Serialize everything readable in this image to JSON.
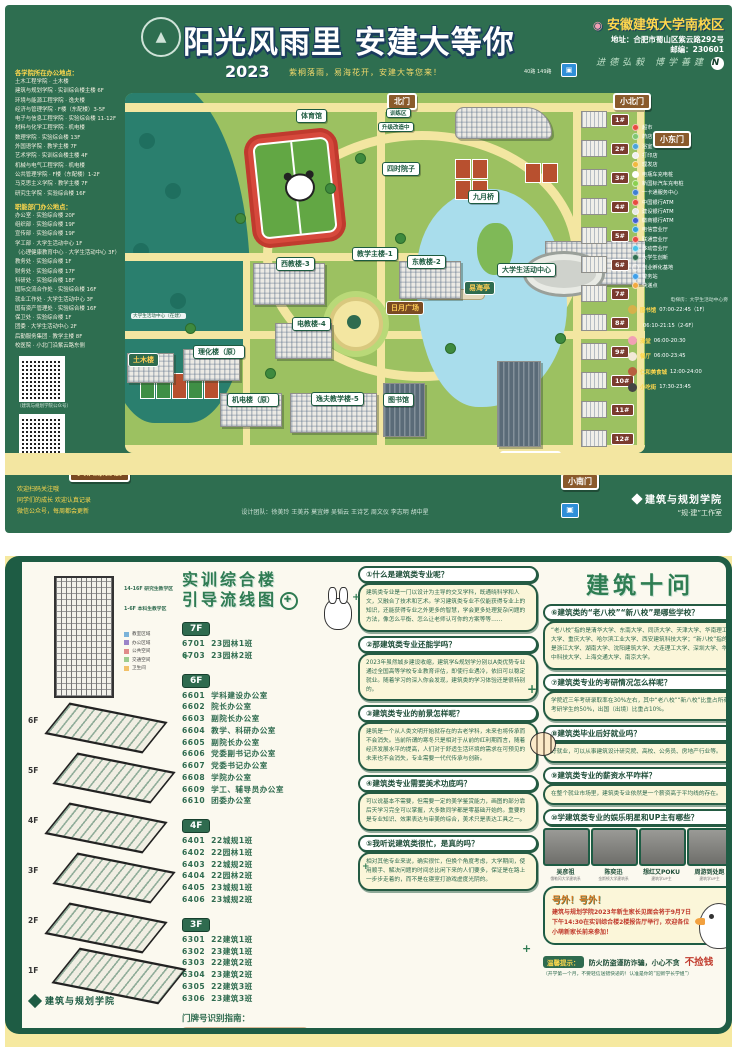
{
  "top_poster": {
    "title": "阳光风雨里 安建大等你",
    "year": "2023",
    "subtitle": "紫桐落雨，易海花开，安建大等您来！",
    "bus_note": "40路 149路",
    "campus": {
      "pin_icon": "📍",
      "name": "安徽建筑大学南校区",
      "address": "地址：合肥市蜀山区紫云路292号",
      "zip": "邮编：230601",
      "motto": "进德弘毅 博学善建",
      "compass": "N"
    },
    "sidebar": {
      "colleges_header": "各学院所在办公地点：",
      "colleges": [
        "土木工程学院 · 土木楼",
        "建筑与规划学院 · 实训综合楼主楼 6F",
        "环境与能源工程学院 · 逸夫楼",
        "经济与管理学院 · F楼（东配楼）3-5F",
        "电子与信息工程学院 · 实验综合楼 11-12F",
        "材料与化学工程学院 · 机电楼",
        "数理学院 · 实验综合楼 13F",
        "外国语学院 · 教学主楼 7F",
        "艺术学院 · 实训综合楼主楼 4F",
        "机械与电气工程学院 · 机电楼",
        "公共管理学院 · F楼（东配楼）1-2F",
        "马克思主义学院 · 教学主楼 7F",
        "研究生学院 · 实验综合楼 16F"
      ],
      "departments_header": "职能部门办公地点：",
      "departments": [
        "办公室 · 实验综合楼 20F",
        "组织部 · 实验综合楼 19F",
        "宣传部 · 实验综合楼 19F",
        "学工部 · 大学生活动中心 1F",
        "（心理健康教育中心 · 大学生活动中心 3F）",
        "教务处 · 实验综合楼 1F",
        "财务处 · 实验综合楼 17F",
        "科研处 · 实验综合楼 18F",
        "国际交流合作处 · 实验综合楼 16F",
        "就业工作处 · 大学生活动中心 3F",
        "国有资产管理处 · 实验综合楼 16F",
        "保卫处 · 实验综合楼 1F",
        "团委 · 大学生活动中心 2F",
        "后勤服务集团 · 教学主楼 8F",
        "校医院 · 小北门沿紫云路东侧"
      ],
      "qr1_caption": "（建筑与规划学院公众号）",
      "qr2_caption": "（规建新媒体中心公众号）",
      "slogans": [
        "欢迎扫码关注哦",
        "同学们的成长 欢迎认真记录",
        "微信公众号，每周都会更新"
      ]
    },
    "map": {
      "gates": {
        "north": "北门",
        "north_small": "小北门",
        "east_small": "小东门",
        "main": "正大门",
        "south_small": "小南门"
      },
      "labels": {
        "gym": "体育馆",
        "training": "训练区",
        "upgrading": "升级改造中",
        "courtyard": "四时院子",
        "bridge": "九月桥",
        "main_teaching": "教学主楼-1",
        "west_teaching": "西教楼-3",
        "east_teaching": "东教楼-2",
        "e_teaching": "电教楼-4",
        "plaza": "日月广场",
        "activity_center": "大学生活动中心",
        "pavilion": "易海亭",
        "yifu": "逸夫教学楼-5",
        "library": "图书馆",
        "mech": "机电楼（原）",
        "lihua": "理化楼（原）",
        "civil": "土木楼",
        "shixun": "实训综合楼",
        "shiyan": "实验综合楼",
        "under_construction": "大学生活动中心（在建）",
        "base_caption": "校园建筑文化教育参观基地（东区）"
      },
      "dorms": [
        "1#",
        "2#",
        "3#",
        "4#",
        "5#",
        "6#",
        "7#",
        "8#",
        "9#",
        "10#",
        "11#",
        "12#"
      ]
    },
    "legend": {
      "items": [
        {
          "color": "#e84a3f",
          "label": "超市"
        },
        {
          "color": "#7fc76f",
          "label": "药店"
        },
        {
          "color": "#4aa3d8",
          "label": "浴室"
        },
        {
          "color": "#f0f0f0",
          "label": "打印店"
        },
        {
          "color": "#f2b93f",
          "label": "理发店"
        },
        {
          "color": "#ffffff",
          "label": "电瓶车充电桩"
        },
        {
          "color": "#8bd14f",
          "label": "新国标汽车充电桩"
        },
        {
          "color": "#3f7fd1",
          "label": "一卡通服务中心"
        },
        {
          "color": "#e84a3f",
          "label": "中国银行ATM"
        },
        {
          "color": "#e8e8e8",
          "label": "建设银行ATM"
        },
        {
          "color": "#3f5fd1",
          "label": "徽商银行ATM"
        },
        {
          "color": "#2f9fd8",
          "label": "电信营业厅"
        },
        {
          "color": "#e84a3f",
          "label": "联通营业厅"
        },
        {
          "color": "#49c2e8",
          "label": "移动营业厅"
        },
        {
          "color": "#2f6e50",
          "label": "大学生创新"
        },
        {
          "color": "transparent",
          "label": "创业孵化基地"
        },
        {
          "color": "#3f9fe8",
          "label": "警务站"
        },
        {
          "color": "#f2a93f",
          "label": "快递点"
        }
      ],
      "elevator_note": "电梯房：大学生活动中心旁",
      "hours": [
        {
          "ic": "#d6b14a",
          "place": "图书馆",
          "time": "07:00-22:45（1F）"
        },
        {
          "ic": "transparent",
          "place": "",
          "time": "06:10-21:15（2-6F）"
        },
        {
          "ic": "#f2a0b5",
          "place": "澡堂",
          "time": "06:00-20:30"
        },
        {
          "ic": "#f2e9d8",
          "place": "餐厅",
          "time": "06:00-23:45"
        },
        {
          "ic": "#b85f3f",
          "place": "仁和美食城",
          "time": "12:00-24:00"
        },
        {
          "ic": "#444444",
          "place": "小吃街",
          "time": "17:30-23:45"
        }
      ]
    },
    "footer": {
      "credits": "设计团队：徐美玲 王美苏 莫宜婷 吴韬云 王诗艺 周文仪 李志明 胡中星",
      "college": "建筑与规划学院",
      "studio": "“规·建”工作室"
    }
  },
  "bottom_poster": {
    "axon": {
      "tower_note1": "14-16F 研究生教学区",
      "tower_note2": "1-6F 本科生教学区",
      "legend": [
        {
          "color": "#7bb3d9",
          "label": "教室区域"
        },
        {
          "color": "#9b84c9",
          "label": "办公区域"
        },
        {
          "color": "#e08a8a",
          "label": "公共空间"
        },
        {
          "color": "#9ccc8f",
          "label": "交通空间"
        },
        {
          "color": "#f2c169",
          "label": "卫生间"
        }
      ],
      "floor_marks": [
        "6F",
        "5F",
        "4F",
        "3F",
        "2F",
        "1F"
      ],
      "college": "建筑与规划学院"
    },
    "guide_title_1": "实训综合楼",
    "guide_title_2": "引导流线图",
    "floors": [
      {
        "badge": "7F",
        "rooms": [
          {
            "no": "6701",
            "name": "23园林1班"
          },
          {
            "no": "6703",
            "name": "23园林2班"
          }
        ]
      },
      {
        "badge": "6F",
        "rooms": [
          {
            "no": "6601",
            "name": "学科建设办公室"
          },
          {
            "no": "6602",
            "name": "院长办公室"
          },
          {
            "no": "6603",
            "name": "副院长办公室"
          },
          {
            "no": "6604",
            "name": "教学、科研办公室"
          },
          {
            "no": "6605",
            "name": "副院长办公室"
          },
          {
            "no": "6606",
            "name": "党委副书记办公室"
          },
          {
            "no": "6607",
            "name": "党委书记办公室"
          },
          {
            "no": "6608",
            "name": "学院办公室"
          },
          {
            "no": "6609",
            "name": "学工、辅导员办公室"
          },
          {
            "no": "6610",
            "name": "团委办公室"
          }
        ]
      },
      {
        "badge": "4F",
        "rooms": [
          {
            "no": "6401",
            "name": "22城规1班"
          },
          {
            "no": "6402",
            "name": "22园林1班"
          },
          {
            "no": "6403",
            "name": "22城规2班"
          },
          {
            "no": "6404",
            "name": "22园林2班"
          },
          {
            "no": "6405",
            "name": "23城规1班"
          },
          {
            "no": "6406",
            "name": "23城规2班"
          }
        ]
      },
      {
        "badge": "3F",
        "rooms": [
          {
            "no": "6301",
            "name": "22建筑1班"
          },
          {
            "no": "6302",
            "name": "23建筑1班"
          },
          {
            "no": "6303",
            "name": "22建筑2班"
          },
          {
            "no": "6304",
            "name": "23建筑2班"
          },
          {
            "no": "6305",
            "name": "22建筑3班"
          },
          {
            "no": "6306",
            "name": "23建筑3班"
          }
        ]
      }
    ],
    "door_guide": {
      "title": "门牌号识别指南：",
      "sample": "6606",
      "captions": "数字代表楼栋 · 数字代表楼层 · 数字代表序号"
    },
    "qa_title": "建筑十问",
    "qa_left": [
      {
        "q": "①什么是建筑类专业呢？",
        "a": "建筑类专业是一门以设计为主导的交叉学科，既通晓科学和人文，又融合了技术和艺术。学习建筑类专业不仅能获得专业上的知识，还能获得专业之外更多的智慧，学会更多处理复杂问题的方法，像怎么平衡、怎么让老师认可你的方案等等……"
      },
      {
        "q": "②那建筑类专业还能学吗？",
        "a": "2023年虽然城乡建设收缩，建筑学&规划学分别以A类优势专业通过全国高等学校专业教育评估，即使行业遇冷，依旧可以稳定就业。随着学习的深入你会发现，建筑类的学习体验还是很特别的。"
      },
      {
        "q": "③建筑类专业的前景怎样呢？",
        "a": "建筑是一个从人类文明开始就存在的古老学科，未来也将传承而不会消失。当前所谓的寒冬只是相对于从前的红利期而言，随着经济发展水平的提高，人们对于舒适生活环境的需求在可预见的未来也不会消失，专业需要一代代传承与创新。"
      },
      {
        "q": "④建筑类专业需要美术功底吗？",
        "a": "可以说基本不需要，但需要一定的美学鉴赏能力，画图的部分靠后天学习完全可以掌握，大多数同学都是零基础开始的。重要的是专业知识、效果表达与审美的综合，美术只是表达工具之一。"
      },
      {
        "q": "⑤我听说建筑类很忙，是真的吗？",
        "a": "相对其他专业来说，确实很忙，但换个角度考虑，大学期间，使用顺手、解决问题的时间总比闲下来的人们要多，保证是在路上一步步走着的，而不是在寝室打游戏虚度光阴的。"
      }
    ],
    "qa_right": [
      {
        "q": "⑥建筑类的“老八校”“新八校”是哪些学校？",
        "a": "“老八校”指的是清华大学、东南大学、同济大学、天津大学、华南理工大学、重庆大学、哈尔滨工业大学、西安建筑科技大学；“新八校”指的是浙江大学、湖南大学、沈阳建筑大学、大连理工大学、深圳大学、华中科技大学、上海交通大学、南京大学。"
      },
      {
        "q": "⑦建筑类专业的考研情况怎么样呢？",
        "a": "学院近三年考研录取率在30%左右，其中“老八校”“新八校”比重占所有考研学生的50%，出国（出境）比重占10%。"
      },
      {
        "q": "⑧建筑类毕业后好就业吗？",
        "a": "好就业，可以从事建筑设计研究院、高校、公务员、房地产行业等。"
      },
      {
        "q": "⑨建筑类专业的薪资水平咋样？",
        "a": "在整个就业市场里，建筑类专业依然是一个薪资高于平均线的存在。"
      },
      {
        "q": "⑩学建筑类专业的娱乐明星和UP主有哪些？",
        "a": ""
      }
    ],
    "celebs": [
      {
        "name": "吴彦祖",
        "caption": "俄勒冈大学建筑系"
      },
      {
        "name": "陈奕迅",
        "caption": "金斯顿大学建筑系"
      },
      {
        "name": "想红又POKU",
        "caption": "建筑学UP主"
      },
      {
        "name": "周游到处跑",
        "caption": "建筑学UP主"
      }
    ],
    "notice": {
      "title": "号外！号外！",
      "body": "建筑与规划学院2023年新生家长见面会将于9月7日下午14:30在实训综合楼2楼报告厅举行，欢迎各位小萌新家长前来参加！"
    },
    "tips": {
      "label": "温馨提示：",
      "body": "防火防盗谨防诈骗，小心不贪",
      "big": "不捡钱",
      "sub": "（开学第一个月，不要轻信送错快递的！认准是你的“迎新学长学姐”）"
    }
  }
}
